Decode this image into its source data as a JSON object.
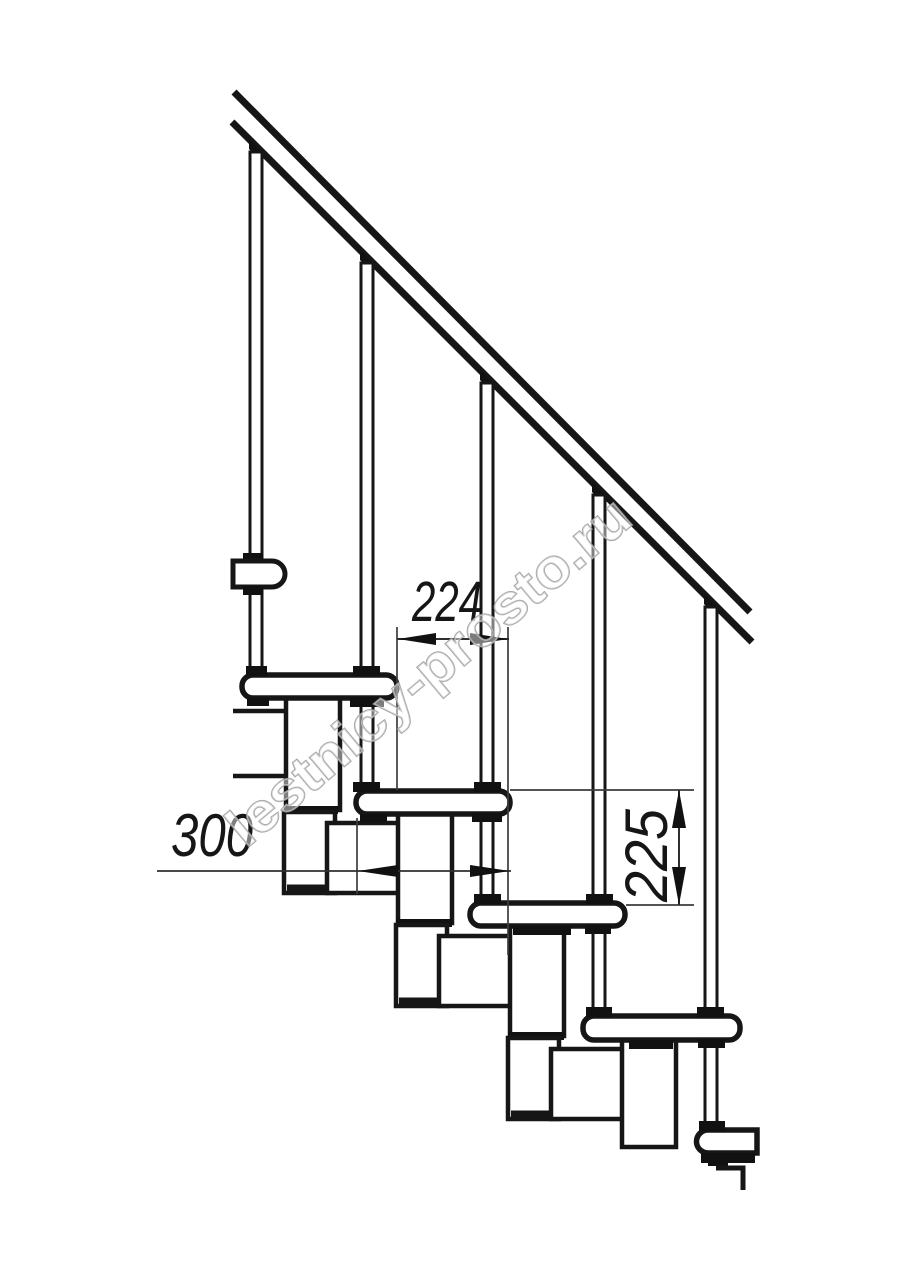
{
  "page": {
    "background": "#ffffff"
  },
  "drawing": {
    "type": "technical-diagram",
    "subject": "modular staircase side elevation with handrail and balusters",
    "line_color": "#161616",
    "dim_color": "#2f2f2f",
    "watermark": {
      "text": "lestnicy-prosto.ru",
      "color": "#9c9c9c"
    },
    "dimensions": {
      "step_run": {
        "value": "224",
        "orientation": "horizontal"
      },
      "tread_depth": {
        "value": "300",
        "orientation": "horizontal"
      },
      "step_rise": {
        "value": "225",
        "orientation": "vertical"
      }
    }
  }
}
